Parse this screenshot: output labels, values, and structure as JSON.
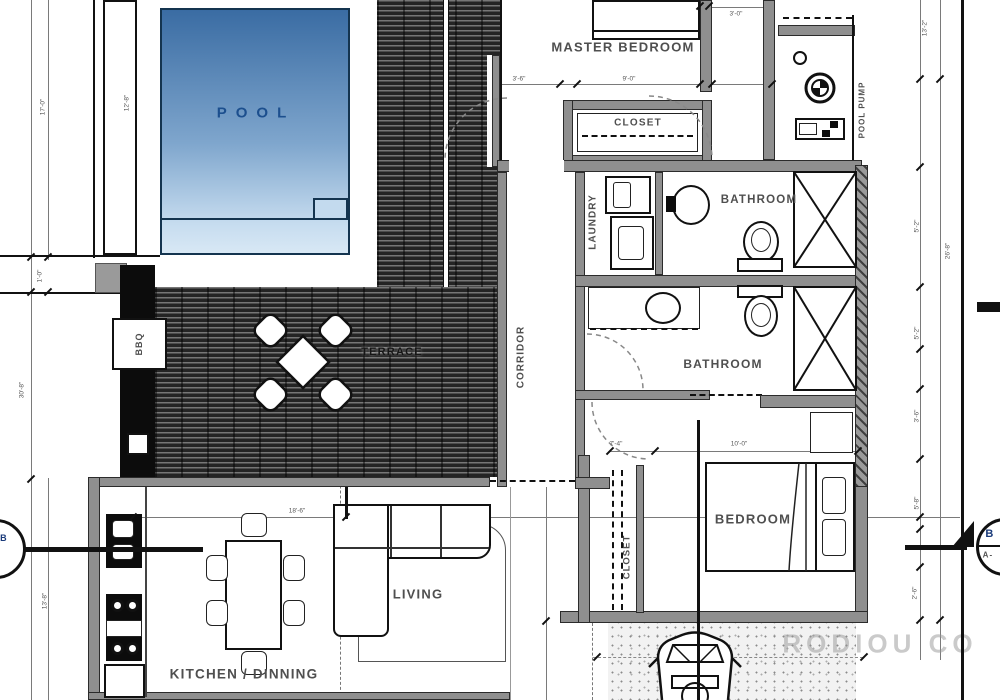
{
  "rooms": {
    "pool": "POOL",
    "master_bedroom": "MASTER BEDROOM",
    "master_closet": "CLOSET",
    "pool_pump": "POOL PUMP",
    "laundry": "LAUNDRY",
    "bathroom_top": "BATHROOM",
    "bathroom_bottom": "BATHROOM",
    "corridor": "CORRIDOR",
    "terrace": "TERRACE",
    "bbq": "BBQ",
    "bedroom": "BEDROOM",
    "bedroom_closet": "CLOSET",
    "living": "LIVING",
    "kitchen_dining": "KITCHEN / DINNING"
  },
  "dims": [
    "3'-6\"",
    "9'-0\"",
    "3'-0\"",
    "13'-2\"",
    "5'-2\"",
    "26'-8\"",
    "5'-2\"",
    "3'-6\"",
    "5'-8\"",
    "2'-6\"",
    "18'-6\"",
    "10'-0\"",
    "7'-4\"",
    "30'-8\"",
    "12'-8\"",
    "17'-0\"",
    "1'-0\"",
    "13'-8\""
  ],
  "section_marker": {
    "top": "B",
    "bottom": "A-"
  },
  "watermark": "RODIOU CO",
  "colors": {
    "wall": "#8f8f8f",
    "pool_deep": "#3a6ca3",
    "pool_mid": "#7fa6cd",
    "pool_shallow": "#c6dcef",
    "pool_border": "#14344f",
    "pool_text": "#1c4f8e",
    "label": "#4f4f4f",
    "dim": "#555555"
  }
}
